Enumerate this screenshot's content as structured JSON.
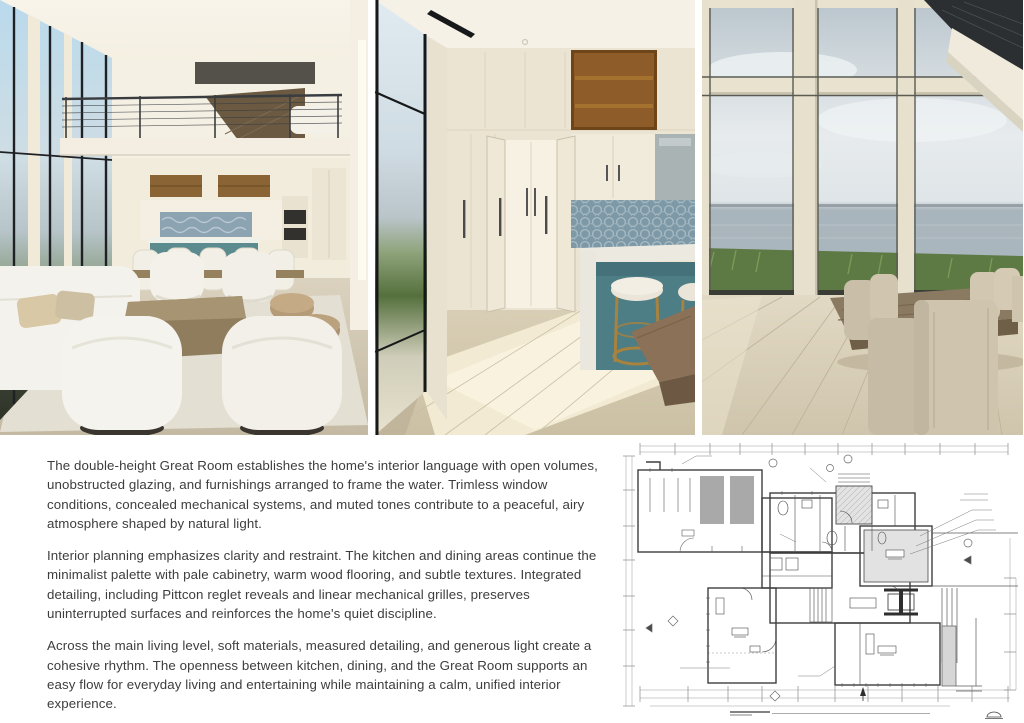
{
  "page": {
    "background": "#ffffff",
    "text_color": "#3d3d3d"
  },
  "article": {
    "paragraphs": [
      "The double-height Great Room establishes the home's interior language with open volumes, unobstructed glazing, and furnishings arranged to frame the water. Trimless window conditions, concealed mechanical systems, and muted tones contribute to a peaceful, airy atmosphere shaped by natural light.",
      "Interior planning emphasizes clarity and restraint. The kitchen and dining areas continue the minimalist palette with pale cabinetry, warm wood flooring, and subtle textures. Integrated detailing, including Pittcon reglet reveals and linear mechanical grilles, preserves uninterrupted surfaces and reinforces the home's quiet discipline.",
      "Across the main living level, soft materials, measured detailing, and generous light create a cohesive rhythm. The openness between kitchen, dining, and the Great Room supports an easy flow for everyday living and entertaining while maintaining a calm, unified interior experience."
    ]
  },
  "photos": [
    {
      "name": "great-room-interior"
    },
    {
      "name": "kitchen-pantry-island"
    },
    {
      "name": "dining-area-water-view"
    }
  ],
  "floor_plan": {
    "name": "first-floor-architectural-plan",
    "line_color": "#4a4a4a",
    "dim_color": "#8a8a8a",
    "shade_color": "#dedede",
    "stall_color": "#a9a9a9"
  },
  "palette": {
    "island_teal": "#4d7d85",
    "tile_blue": "#7d98a6",
    "wood_shelf": "#8d5c28",
    "marsh_green": "#5d7a44",
    "cream_wall": "#efe8d9"
  }
}
